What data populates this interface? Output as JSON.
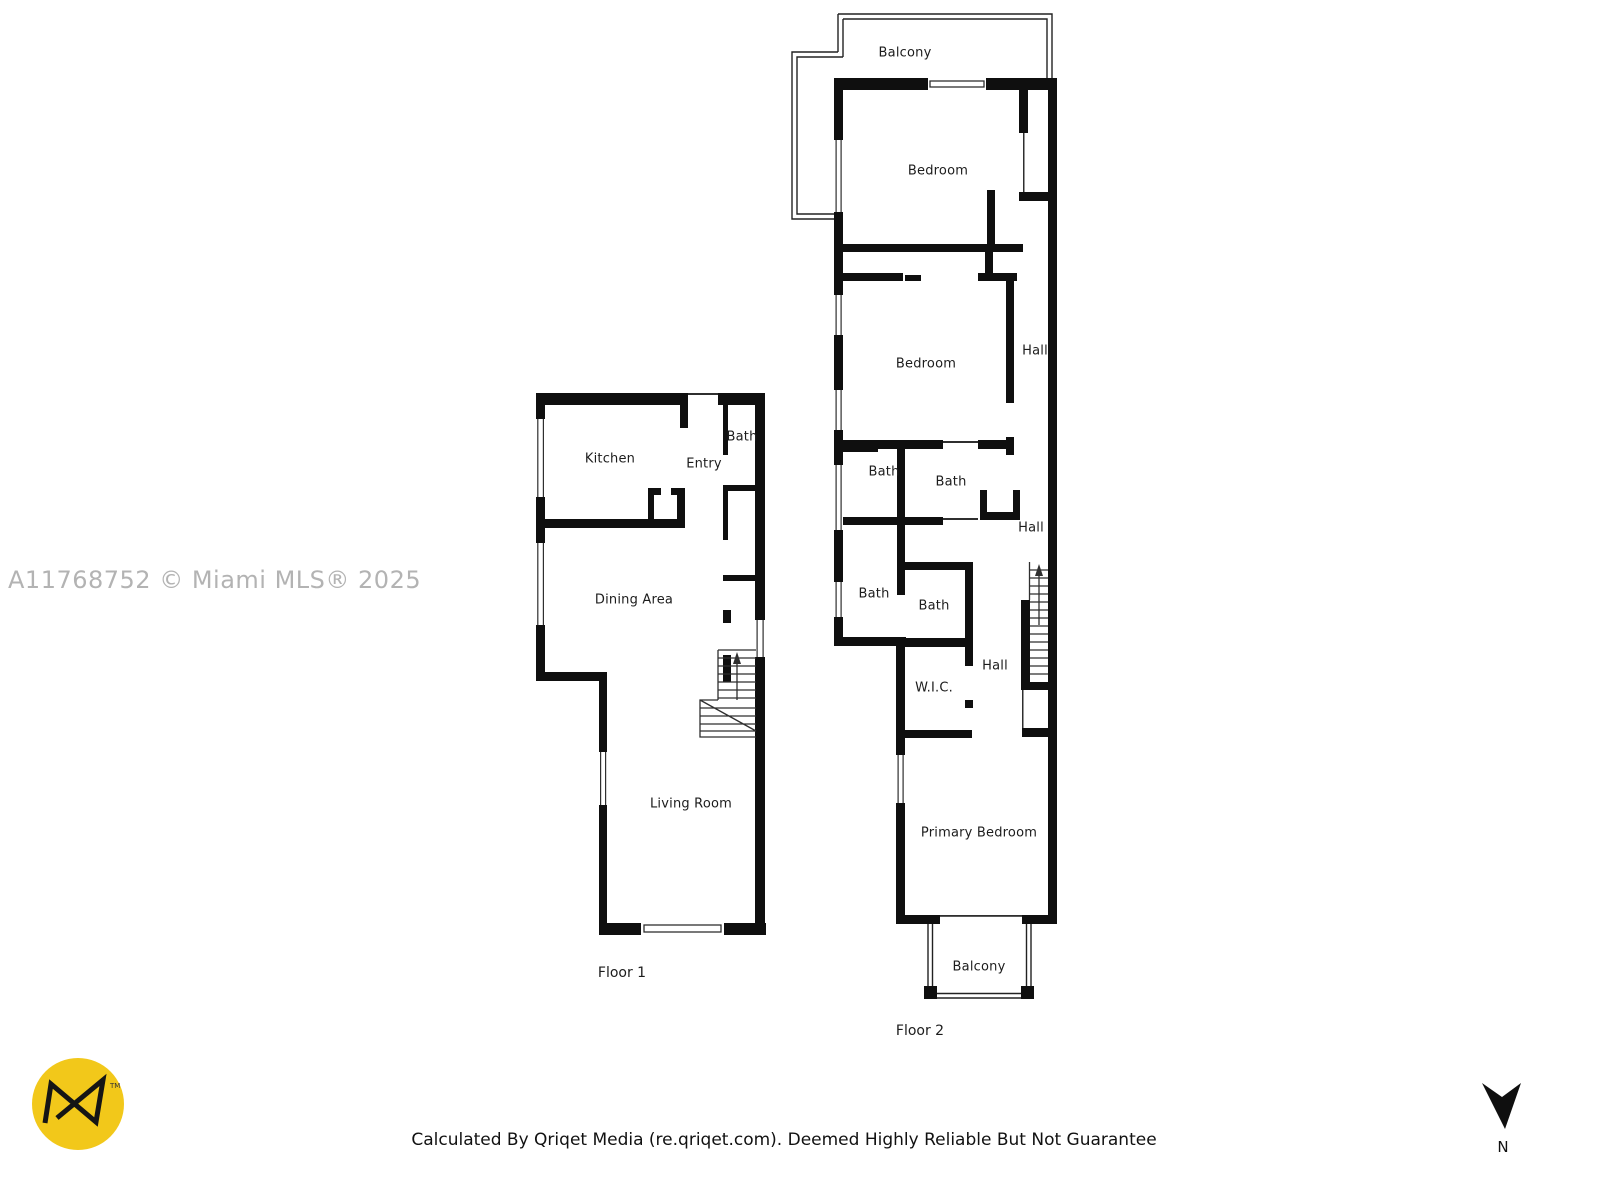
{
  "watermark": "A11768752 © Miami MLS® 2025",
  "disclaimer": "Calculated By Qriqet Media (re.qriqet.com). Deemed Highly Reliable But Not Guarantee",
  "compass": {
    "label": "N"
  },
  "logo": {
    "tm": "TM"
  },
  "colors": {
    "wall": "#0f0f0f",
    "background": "#ffffff",
    "logo_yellow": "#F2C81A",
    "watermark_gray": "#b3b3b3"
  },
  "floors": [
    {
      "name": "Floor 1",
      "rooms": [
        {
          "label": "Kitchen"
        },
        {
          "label": "Entry"
        },
        {
          "label": "Bath"
        },
        {
          "label": "Dining Area"
        },
        {
          "label": "Living Room"
        }
      ]
    },
    {
      "name": "Floor 2",
      "rooms": [
        {
          "label": "Balcony"
        },
        {
          "label": "Bedroom"
        },
        {
          "label": "Bedroom"
        },
        {
          "label": "Hall"
        },
        {
          "label": "Bath"
        },
        {
          "label": "Bath"
        },
        {
          "label": "Hall"
        },
        {
          "label": "Bath"
        },
        {
          "label": "Bath"
        },
        {
          "label": "Hall"
        },
        {
          "label": "W.I.C."
        },
        {
          "label": "Primary Bedroom"
        },
        {
          "label": "Balcony"
        }
      ]
    }
  ]
}
